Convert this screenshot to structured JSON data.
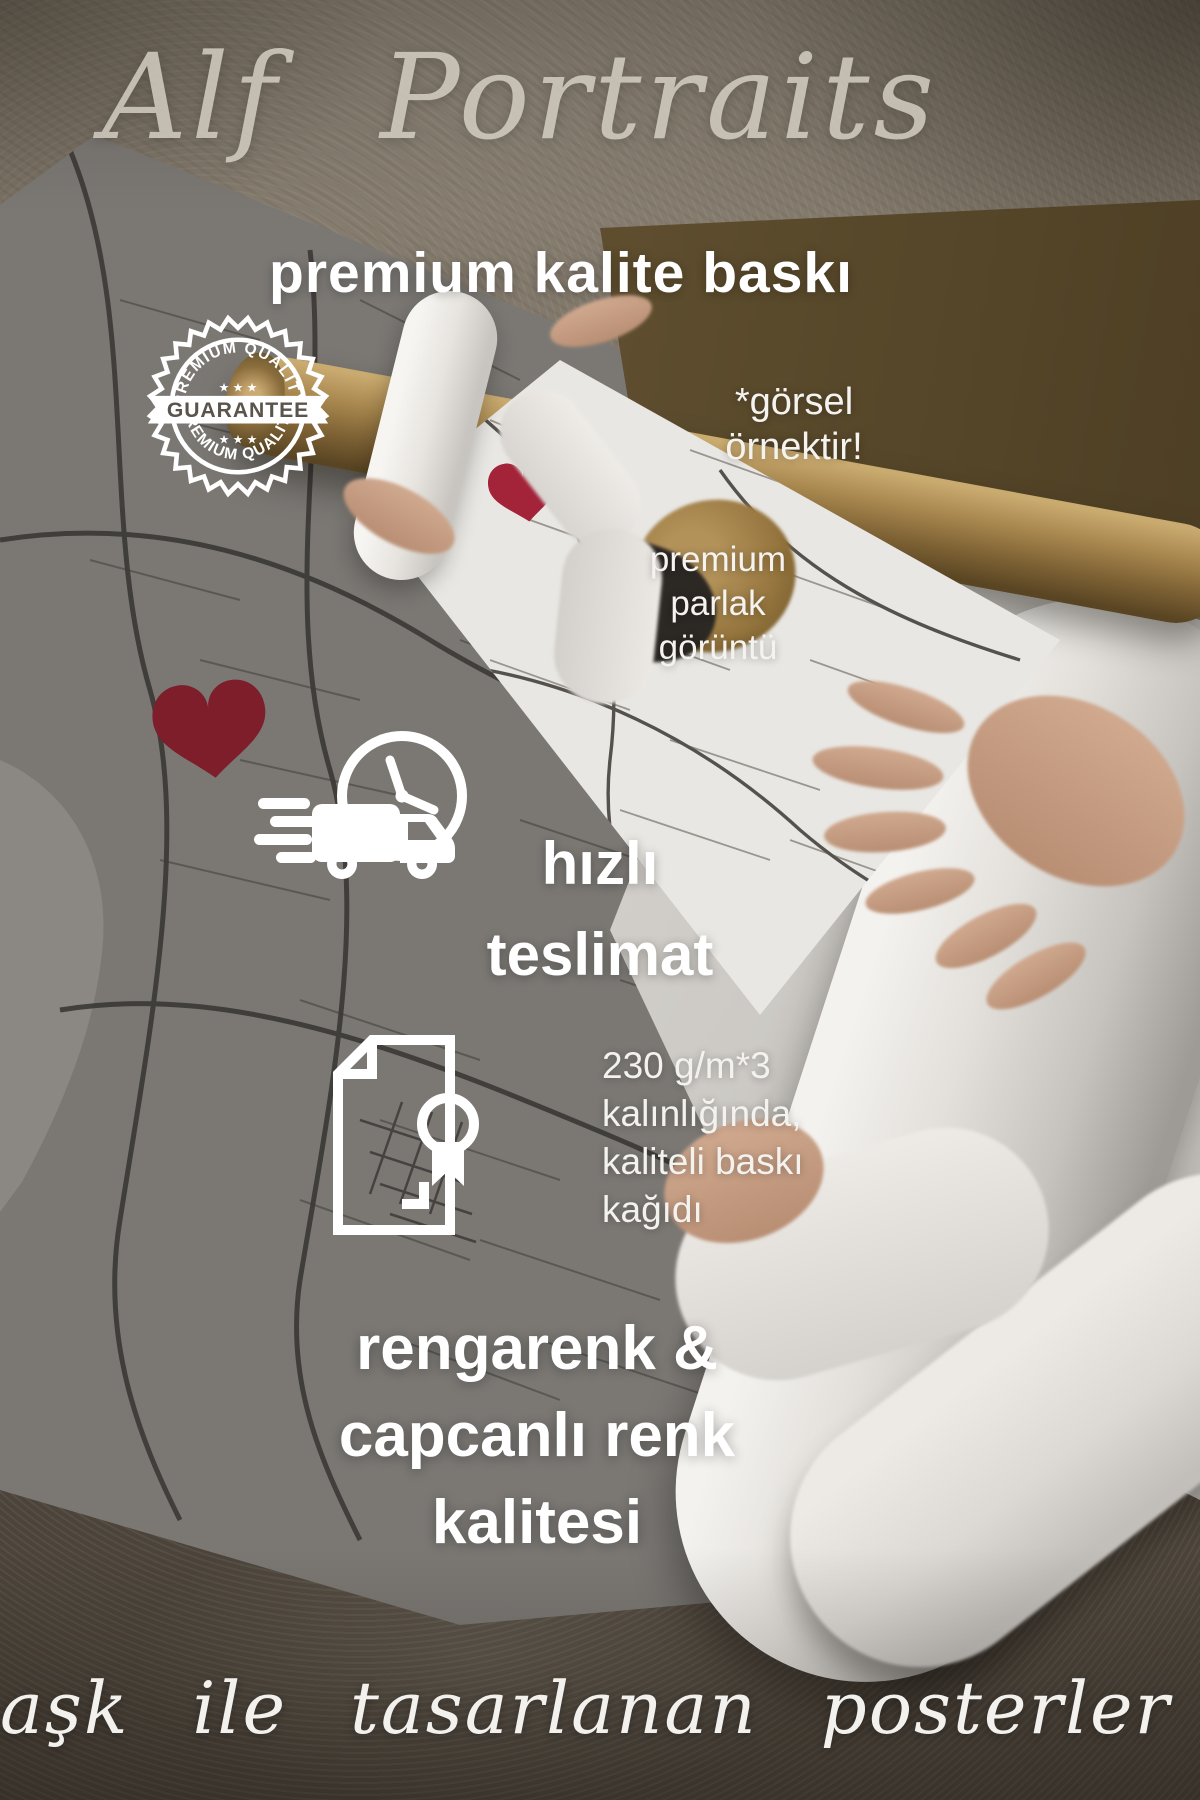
{
  "brand": {
    "script_title": "Alf Portraits"
  },
  "headline": "premium kalite baskı",
  "stamp": {
    "arc_top": "PREMIUM QUALITY",
    "arc_bottom": "PREMIUM QUALITY",
    "banner": "GUARANTEE",
    "stars_top": "★ ★ ★",
    "stars_bottom": "★ ★ ★"
  },
  "annotations": {
    "sample_note": {
      "line1": "*görsel",
      "line2": "örnektir!"
    },
    "gloss_note": {
      "line1": "premium",
      "line2": "parlak",
      "line3": "görüntü"
    }
  },
  "features": {
    "delivery": {
      "icon": "fast-delivery-truck-clock-icon",
      "line1": "hızlı",
      "line2": "teslimat"
    },
    "paper": {
      "icon": "print-paper-award-icon",
      "line1": "230 g/m*3",
      "line2": "kalınlığında,",
      "line3": "kaliteli baskı",
      "line4": "kağıdı"
    },
    "color": {
      "line1": "rengarenk &",
      "line2": "capcanlı renk",
      "line3": "kalitesi"
    }
  },
  "footer": {
    "script_tagline": "aşk ile tasarlanan posterler"
  },
  "colors": {
    "heart_red_dark": "#7d1e2a",
    "heart_red_bright": "#a32339",
    "kraft_brown": "#9b7c49",
    "text_white": "#ffffff",
    "script_gray": "#dcd6cb"
  }
}
